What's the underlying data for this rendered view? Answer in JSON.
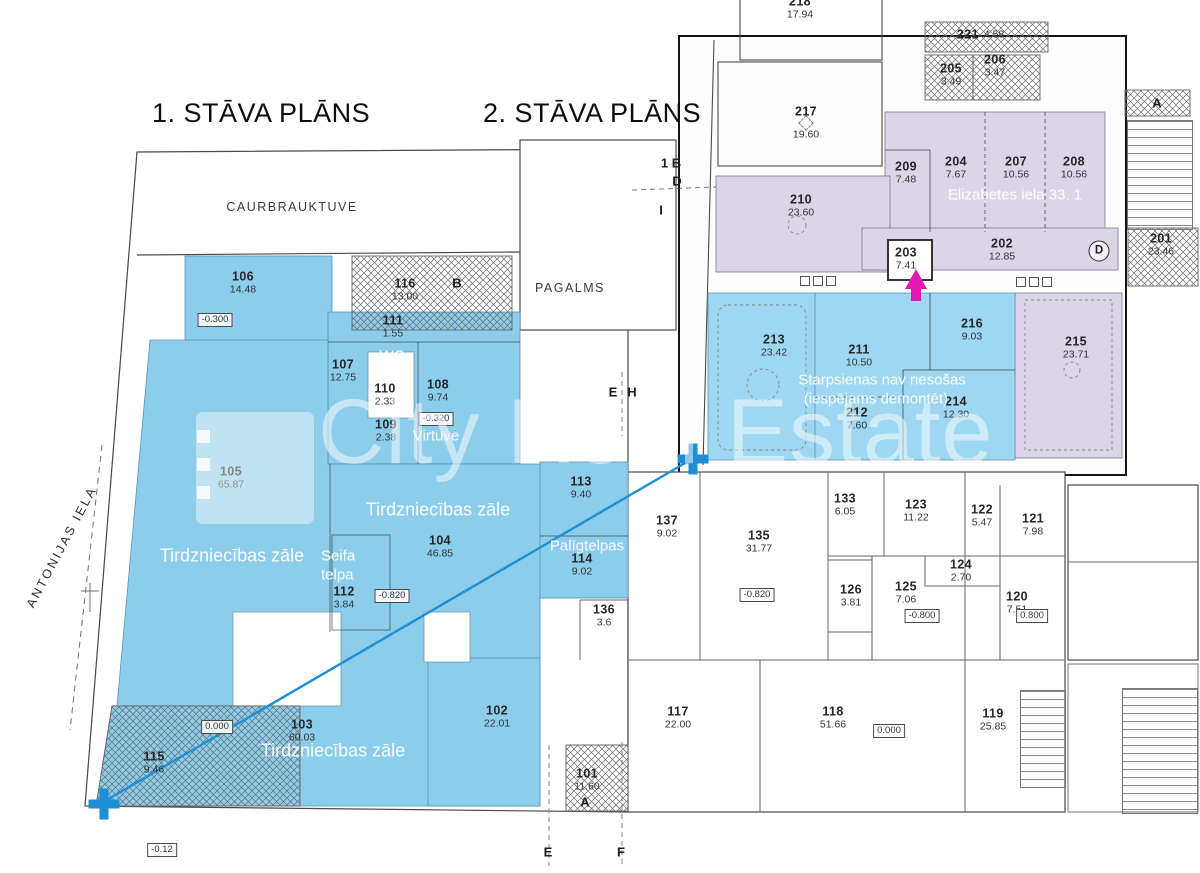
{
  "titles": {
    "floor1": "1. STĀVA PLĀNS",
    "floor2": "2. STĀVA PLĀNS"
  },
  "watermark": {
    "brand": "City Real Estate"
  },
  "colors": {
    "highlight_blue_floor1": "#8CCDEC",
    "highlight_blue_floor2": "#9DD7F1",
    "highlight_lavender": "#DBD5E7",
    "marker_blue": "#1E8FD5",
    "marker_magenta": "#E616B4"
  },
  "floor1": {
    "street_label": "ANTONIJAS IELA",
    "zone_labels": [
      "CAURBRAUKTUVE",
      "PAGALMS"
    ],
    "overlays": [
      "Tirdzniecības zāle",
      "Tirdzniecības zāle",
      "Tirdzniecības zāle",
      "Seifa telpa",
      "WC",
      "Virtuve",
      "Palīgtelpas"
    ],
    "rooms": [
      {
        "number": "101",
        "area": "11.60"
      },
      {
        "number": "102",
        "area": "22.01"
      },
      {
        "number": "103",
        "area": "60.03"
      },
      {
        "number": "104",
        "area": "46.85"
      },
      {
        "number": "105",
        "area": "65.87"
      },
      {
        "number": "106",
        "area": "14.48"
      },
      {
        "number": "107",
        "area": "12.75"
      },
      {
        "number": "108",
        "area": "9.74"
      },
      {
        "number": "109",
        "area": "2.38"
      },
      {
        "number": "110",
        "area": "2.33"
      },
      {
        "number": "111",
        "area": "1.55"
      },
      {
        "number": "112",
        "area": "3.84"
      },
      {
        "number": "113",
        "area": "9.40"
      },
      {
        "number": "114",
        "area": "9.02"
      },
      {
        "number": "115",
        "area": "9.46"
      },
      {
        "number": "116",
        "area": "13.00"
      },
      {
        "number": "117",
        "area": "22.00"
      },
      {
        "number": "118",
        "area": "51.66"
      },
      {
        "number": "119",
        "area": "25.85"
      },
      {
        "number": "120",
        "area": "7.51"
      },
      {
        "number": "121",
        "area": "7.98"
      },
      {
        "number": "122",
        "area": "5.47"
      },
      {
        "number": "123",
        "area": "11.22"
      },
      {
        "number": "124",
        "area": "2.70"
      },
      {
        "number": "125",
        "area": "7.06"
      },
      {
        "number": "126",
        "area": "3.81"
      },
      {
        "number": "133",
        "area": "6.05"
      },
      {
        "number": "135",
        "area": "31.77"
      },
      {
        "number": "136",
        "area": "3.6"
      },
      {
        "number": "137",
        "area": "9.02"
      }
    ],
    "elevations": [
      "-0.300",
      "-0.320",
      "-0.820",
      "0.000",
      "-0.820",
      "-0.800",
      "0.800",
      "0.000",
      "-0.12"
    ],
    "axis_letters": [
      "B",
      "A",
      "E",
      "F",
      "E",
      "H"
    ]
  },
  "floor2": {
    "address_overlay": "Elizabetes iela 33. 1",
    "note_line1": "Starpsienas nav nesošas",
    "note_line2": "(iespējams demontēt)",
    "rooms": [
      {
        "number": "201",
        "area": "23.46"
      },
      {
        "number": "202",
        "area": "12.85"
      },
      {
        "number": "203",
        "area": "7.41"
      },
      {
        "number": "204",
        "area": "7.67"
      },
      {
        "number": "205",
        "area": "3.49"
      },
      {
        "number": "206",
        "area": "3.47"
      },
      {
        "number": "207",
        "area": "10.56"
      },
      {
        "number": "208",
        "area": "10.56"
      },
      {
        "number": "209",
        "area": "7.48"
      },
      {
        "number": "210",
        "area": "23.60"
      },
      {
        "number": "211",
        "area": "10.50"
      },
      {
        "number": "212",
        "area": "7.60"
      },
      {
        "number": "213",
        "area": "23.42"
      },
      {
        "number": "214",
        "area": "12.30"
      },
      {
        "number": "215",
        "area": "23.71"
      },
      {
        "number": "216",
        "area": "9.03"
      },
      {
        "number": "217",
        "area": "19.60"
      },
      {
        "number": "218",
        "area": "17.94"
      },
      {
        "number": "221",
        "area": "4.58"
      }
    ],
    "axis_letters": [
      "1 B",
      "D",
      "I",
      "D",
      "A"
    ]
  }
}
